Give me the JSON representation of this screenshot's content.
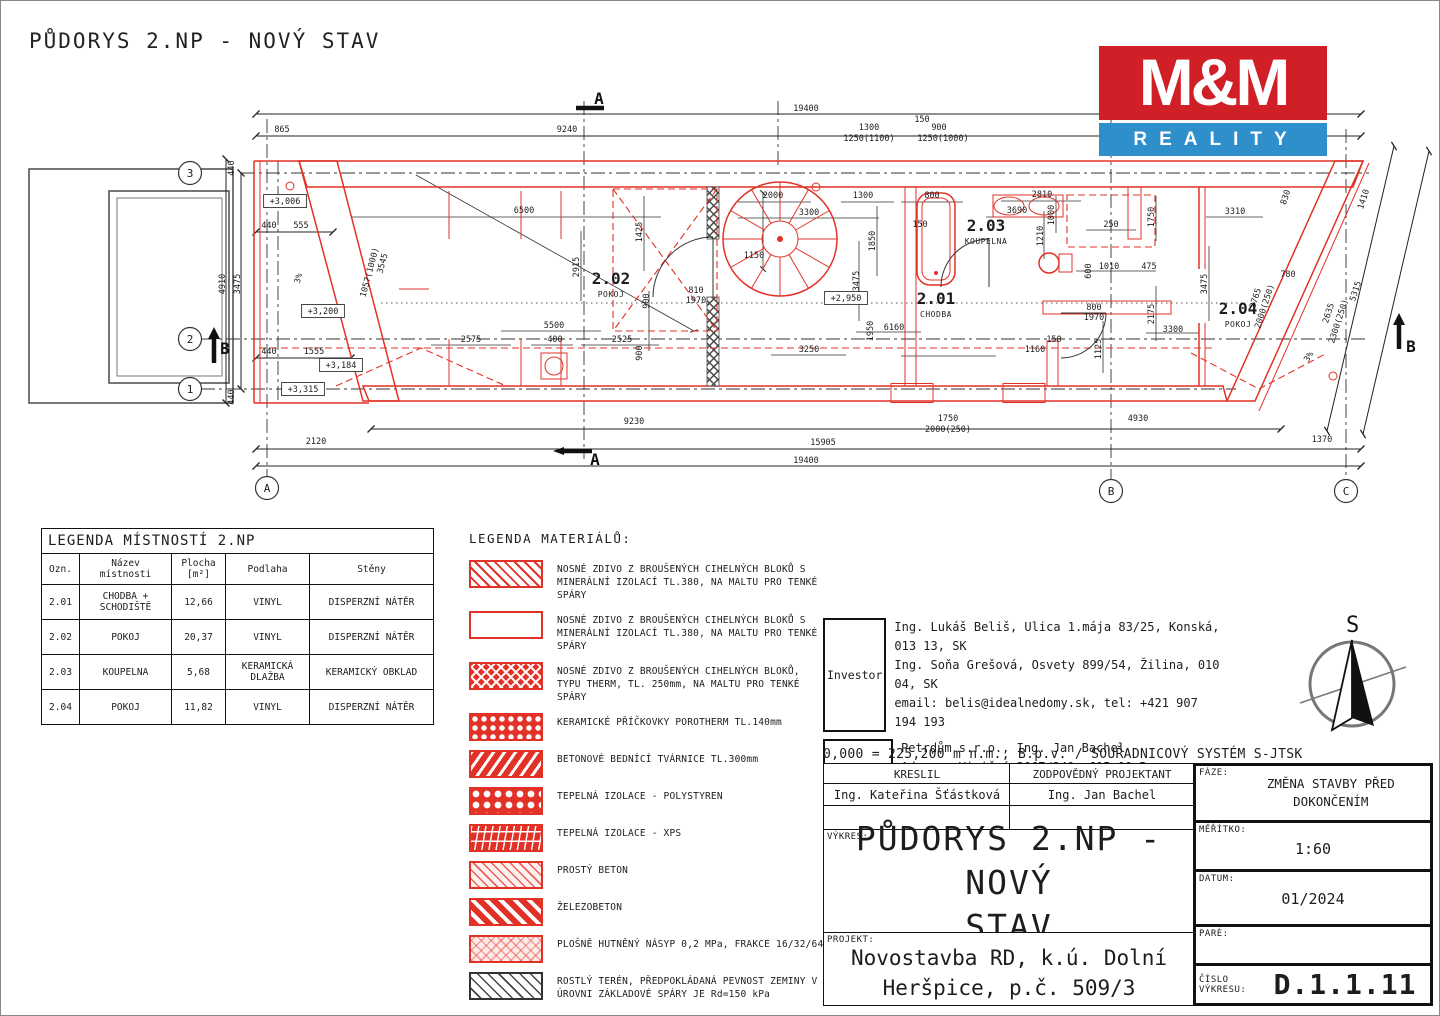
{
  "page": {
    "title": "PŮDORYS 2.NP - NOVÝ STAV"
  },
  "logo": {
    "line1": "M&M",
    "line2": "REALITY",
    "red": "#d01f27",
    "blue": "#2e8fca"
  },
  "compass": {
    "north_label": "S"
  },
  "room_legend": {
    "title": "LEGENDA MÍSTNOSTÍ 2.NP",
    "columns": [
      "Ozn.",
      "Název místnosti",
      "Plocha [m²]",
      "Podlaha",
      "Stěny"
    ],
    "rows": [
      [
        "2.01",
        "CHODBA + SCHODIŠTĚ",
        "12,66",
        "VINYL",
        "DISPERZNÍ NÁTĚR"
      ],
      [
        "2.02",
        "POKOJ",
        "20,37",
        "VINYL",
        "DISPERZNÍ NÁTĚR"
      ],
      [
        "2.03",
        "KOUPELNA",
        "5,68",
        "KERAMICKÁ DLAŽBA",
        "KERAMICKÝ OBKLAD"
      ],
      [
        "2.04",
        "POKOJ",
        "11,82",
        "VINYL",
        "DISPERZNÍ NÁTĚR"
      ]
    ]
  },
  "materials_legend": {
    "title": "LEGENDA MATERIÁLŮ:",
    "items": [
      {
        "swatch": "diag-light",
        "label": "NOSNÉ ZDIVO Z BROUŠENÝCH CIHELNÝCH BLOKŮ S MINERÁLNÍ IZOLACÍ TL.380, NA MALTU PRO TENKÉ SPÁRY"
      },
      {
        "swatch": "empty",
        "label": "NOSNÉ ZDIVO Z BROUŠENÝCH CIHELNÝCH BLOKŮ S MINERÁLNÍ IZOLACÍ TL.380, NA MALTU PRO TENKÉ SPÁRY"
      },
      {
        "swatch": "therm",
        "label": "NOSNÉ ZDIVO Z BROUŠENÝCH CIHELNÝCH BLOKŮ, TYPU THERM, TL. 250mm, NA MALTU PRO TENKÉ SPÁRY"
      },
      {
        "swatch": "porotherm",
        "label": "KERAMICKÉ PŘÍČKOVKY POROTHERM TL.140mm"
      },
      {
        "swatch": "bednici",
        "label": "BETONOVÉ BEDNÍCÍ TVÁRNICE TL.300mm"
      },
      {
        "swatch": "polystyren",
        "label": "TEPELNÁ IZOLACE - POLYSTYREN"
      },
      {
        "swatch": "xps",
        "label": "TEPELNÁ IZOLACE - XPS"
      },
      {
        "swatch": "beton",
        "label": "PROSTÝ BETON"
      },
      {
        "swatch": "zelezobeton",
        "label": "ŽELEZOBETON"
      },
      {
        "swatch": "nasyp",
        "label": "PLOŠNĚ HUTNĚNÝ NÁSYP 0,2 MPa, FRAKCE 16/32/64"
      },
      {
        "swatch": "teren",
        "label": "ROSTLÝ TERÉN, PŘEDPOKLÁDANÁ PEVNOST ZEMINY V ÚROVNI ZÁKLADOVÉ SPÁRY JE Rd=150 kPa"
      }
    ]
  },
  "info": {
    "investor_label": "Investor",
    "investor_lines": "Ing. Lukáš Beliš, Ulica 1.mája 83/25, Konská, 013 13, SK\nIng. Soňa Grešová, Osvety 899/54, Žilina, 010 04, SK\nemail: belis@idealnedomy.sk, tel: +421 907 194 193",
    "office_label": "Projekční Kancelář",
    "office_lines": "Petrdům s.r.o., Ing. Jan Bachel\nAdresa: Viniční 3067/240, 615 00 Brno\nemail: bachel@projekt1980.cz, tel: +420 777 071 714",
    "datum_line": "0,000 = 225,200 m n.m., B.p.v. / SOUŘADNICOVÝ SYSTÉM S-JTSK"
  },
  "title_block": {
    "kreslil_label": "KRESLIL",
    "kreslil": "Ing. Kateřina Šťástková",
    "projektant_label": "ZODPOVĚDNÝ PROJEKTANT",
    "projektant": "Ing. Jan Bachel",
    "vykres_label": "VÝKRES:",
    "vykres_line1": "PŮDORYS 2.NP - NOVÝ",
    "vykres_line2": "STAV",
    "projekt_label": "PROJEKT:",
    "projekt_line1": "Novostavba RD, k.ú. Dolní",
    "projekt_line2": "Heršpice, p.č. 509/3",
    "faze_label": "FÁZE:",
    "faze_line1": "ZMĚNA STAVBY PŘED",
    "faze_line2": "DOKONČENÍM",
    "meritko_label": "MĚŘÍTKO:",
    "meritko": "1:60",
    "datum_label": "DATUM:",
    "datum": "01/2024",
    "pare_label": "PARÉ:",
    "pare": "",
    "cislo_label": "ČÍSLO VÝKRESU:",
    "cislo": "D.1.1.11"
  },
  "plan": {
    "grid_row_bubbles": [
      {
        "t": "3",
        "x": 189,
        "y": 172
      },
      {
        "t": "2",
        "x": 189,
        "y": 338
      },
      {
        "t": "1",
        "x": 189,
        "y": 388
      }
    ],
    "grid_col_bubbles": [
      {
        "t": "A",
        "x": 266,
        "y": 487
      },
      {
        "t": "B",
        "x": 1110,
        "y": 490
      },
      {
        "t": "C",
        "x": 1345,
        "y": 490
      }
    ],
    "rooms": [
      {
        "num": "2.02",
        "name": "POKOJ",
        "x": 610,
        "y": 283
      },
      {
        "num": "2.01",
        "name": "CHODBA",
        "x": 935,
        "y": 303
      },
      {
        "num": "2.03",
        "name": "KOUPELNA",
        "x": 985,
        "y": 230
      },
      {
        "num": "2.04",
        "name": "POKOJ",
        "x": 1237,
        "y": 313
      }
    ],
    "elevations": [
      {
        "t": "+3,006",
        "x": 284,
        "y": 203
      },
      {
        "t": "+3,200",
        "x": 322,
        "y": 313
      },
      {
        "t": "+3,184",
        "x": 340,
        "y": 367
      },
      {
        "t": "+3,315",
        "x": 302,
        "y": 391
      },
      {
        "t": "+2,950",
        "x": 845,
        "y": 300
      }
    ],
    "sections": [
      {
        "t": "A",
        "x": 598,
        "y": 103
      },
      {
        "t": "A",
        "x": 594,
        "y": 464
      },
      {
        "t": "B",
        "x": 224,
        "y": 353
      },
      {
        "t": "B",
        "x": 1410,
        "y": 351
      }
    ],
    "dims": [
      {
        "t": "19400",
        "x": 805,
        "y": 110
      },
      {
        "t": "865",
        "x": 281,
        "y": 131
      },
      {
        "t": "9240",
        "x": 566,
        "y": 131
      },
      {
        "t": "1300",
        "x": 868,
        "y": 129
      },
      {
        "t": "1250(1100)",
        "x": 868,
        "y": 140
      },
      {
        "t": "150",
        "x": 921,
        "y": 121
      },
      {
        "t": "900",
        "x": 938,
        "y": 129
      },
      {
        "t": "1250(1000)",
        "x": 942,
        "y": 140
      },
      {
        "t": "4910",
        "x": 224,
        "y": 283,
        "r": -90
      },
      {
        "t": "3475",
        "x": 239,
        "y": 283,
        "r": -90
      },
      {
        "t": "440",
        "x": 233,
        "y": 167,
        "r": -90
      },
      {
        "t": "440",
        "x": 233,
        "y": 396,
        "r": -90
      },
      {
        "t": "440",
        "x": 268,
        "y": 227
      },
      {
        "t": "555",
        "x": 300,
        "y": 227
      },
      {
        "t": "440",
        "x": 268,
        "y": 353
      },
      {
        "t": "1555",
        "x": 313,
        "y": 353
      },
      {
        "t": "3%",
        "x": 300,
        "y": 278,
        "r": -75
      },
      {
        "t": "3545",
        "x": 384,
        "y": 263,
        "r": -75
      },
      {
        "t": "1057(1000)",
        "x": 371,
        "y": 272,
        "r": -75
      },
      {
        "t": "6500",
        "x": 523,
        "y": 212
      },
      {
        "t": "2915",
        "x": 578,
        "y": 266,
        "r": -90
      },
      {
        "t": "1425",
        "x": 641,
        "y": 231,
        "r": -90
      },
      {
        "t": "900",
        "x": 648,
        "y": 300,
        "r": -90
      },
      {
        "t": "900",
        "x": 641,
        "y": 352,
        "r": -90
      },
      {
        "t": "2575",
        "x": 470,
        "y": 341
      },
      {
        "t": "400",
        "x": 554,
        "y": 341
      },
      {
        "t": "5500",
        "x": 553,
        "y": 327
      },
      {
        "t": "2525",
        "x": 621,
        "y": 341
      },
      {
        "t": "2000",
        "x": 772,
        "y": 197
      },
      {
        "t": "3300",
        "x": 808,
        "y": 214
      },
      {
        "t": "1300",
        "x": 862,
        "y": 197
      },
      {
        "t": "1150",
        "x": 753,
        "y": 257
      },
      {
        "t": "1850",
        "x": 874,
        "y": 240,
        "r": -90
      },
      {
        "t": "3475",
        "x": 858,
        "y": 280,
        "r": -90
      },
      {
        "t": "1950",
        "x": 872,
        "y": 330,
        "r": -90
      },
      {
        "t": "6160",
        "x": 893,
        "y": 329
      },
      {
        "t": "3250",
        "x": 808,
        "y": 351
      },
      {
        "t": "810",
        "x": 695,
        "y": 292
      },
      {
        "t": "1970",
        "x": 695,
        "y": 302
      },
      {
        "t": "800",
        "x": 931,
        "y": 197
      },
      {
        "t": "150",
        "x": 919,
        "y": 226
      },
      {
        "t": "2810",
        "x": 1041,
        "y": 196
      },
      {
        "t": "3690",
        "x": 1016,
        "y": 212
      },
      {
        "t": "1000",
        "x": 1053,
        "y": 214,
        "r": -90
      },
      {
        "t": "1210",
        "x": 1042,
        "y": 235,
        "r": -90
      },
      {
        "t": "250",
        "x": 1110,
        "y": 226
      },
      {
        "t": "1750",
        "x": 1153,
        "y": 216,
        "r": -90
      },
      {
        "t": "1010",
        "x": 1108,
        "y": 268
      },
      {
        "t": "475",
        "x": 1148,
        "y": 268
      },
      {
        "t": "600",
        "x": 1090,
        "y": 270,
        "r": -90
      },
      {
        "t": "800",
        "x": 1093,
        "y": 309
      },
      {
        "t": "1970",
        "x": 1093,
        "y": 319
      },
      {
        "t": "150",
        "x": 1053,
        "y": 341
      },
      {
        "t": "1160",
        "x": 1034,
        "y": 351
      },
      {
        "t": "1125",
        "x": 1100,
        "y": 348,
        "r": -90
      },
      {
        "t": "2175",
        "x": 1153,
        "y": 313,
        "r": -90
      },
      {
        "t": "3300",
        "x": 1172,
        "y": 331
      },
      {
        "t": "3310",
        "x": 1234,
        "y": 213
      },
      {
        "t": "3475",
        "x": 1206,
        "y": 283,
        "r": -90
      },
      {
        "t": "830",
        "x": 1287,
        "y": 197,
        "r": -72
      },
      {
        "t": "780",
        "x": 1287,
        "y": 276
      },
      {
        "t": "2765",
        "x": 1257,
        "y": 298,
        "r": -72
      },
      {
        "t": "2000(250)",
        "x": 1266,
        "y": 306,
        "r": -72
      },
      {
        "t": "2635",
        "x": 1330,
        "y": 313,
        "r": -72
      },
      {
        "t": "2300(250)",
        "x": 1340,
        "y": 321,
        "r": -72
      },
      {
        "t": "5315",
        "x": 1357,
        "y": 291,
        "r": -72
      },
      {
        "t": "1410",
        "x": 1365,
        "y": 199,
        "r": -72
      },
      {
        "t": "3%",
        "x": 1310,
        "y": 357,
        "r": -60
      },
      {
        "t": "9230",
        "x": 633,
        "y": 423
      },
      {
        "t": "1750",
        "x": 947,
        "y": 420
      },
      {
        "t": "2000(250)",
        "x": 947,
        "y": 431
      },
      {
        "t": "4930",
        "x": 1137,
        "y": 420
      },
      {
        "t": "2120",
        "x": 315,
        "y": 443
      },
      {
        "t": "15905",
        "x": 822,
        "y": 444
      },
      {
        "t": "1370",
        "x": 1321,
        "y": 441
      },
      {
        "t": "19400",
        "x": 805,
        "y": 462
      }
    ]
  }
}
